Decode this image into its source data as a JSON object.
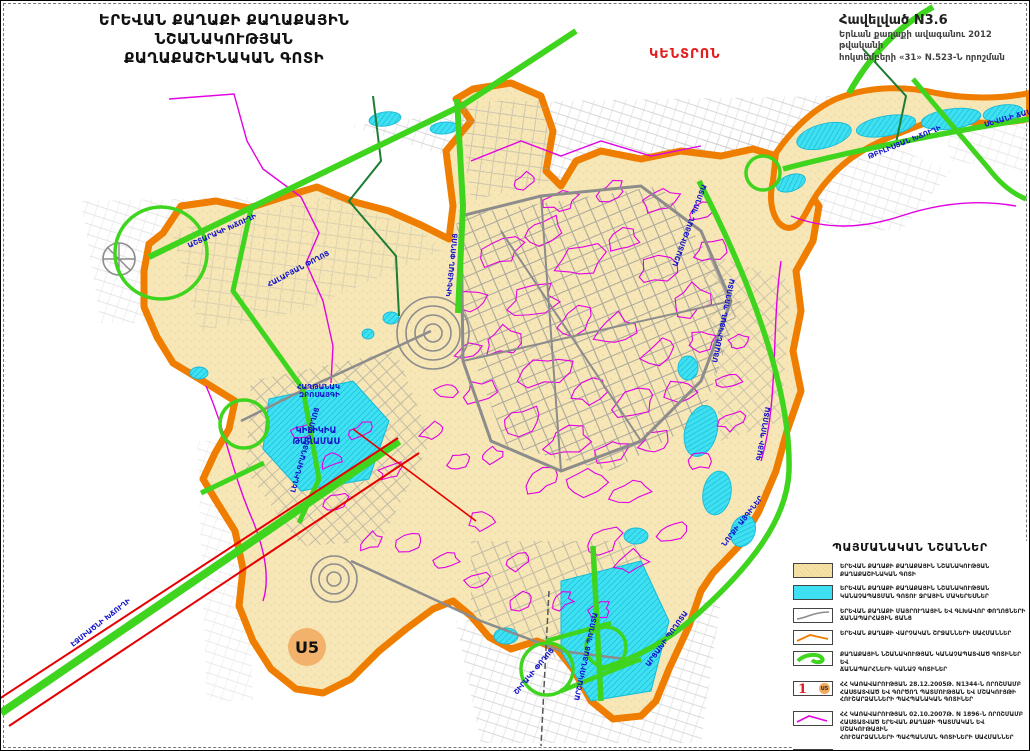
{
  "title": {
    "line1": "ԵՐԵՎԱՆ ՔԱՂԱՔԻ ՔԱՂԱՔԱՅԻՆ ՆՇԱՆԱԿՈՒԹՅԱՆ",
    "line2": "ՔԱՂԱՔԱՇԻՆԱԿԱՆ ԳՈՏԻ"
  },
  "annotation": {
    "line1": "Հավելված N3.6",
    "line2": "Երևան քաղաքի ավագանու 2012 թվականի",
    "line3": "հոկտեմբերի «31» N.523-Ն   որոշման"
  },
  "district_label": "ԿԵՆՏՐՈՆ",
  "map": {
    "marker_u5": "U5",
    "area_label": {
      "line1": "ԿԻԼԻԿԻԱ",
      "line2": "ԹԱՂԱՄԱՍ"
    },
    "street_labels": [
      {
        "text": "ԱՇՏԱՐԱԿԻ ԽՃՈՒՂԻ",
        "x": 188,
        "y": 247,
        "rot": -24
      },
      {
        "text": "ՀԱԼԱԲՅԱՆ ՓՈՂՈՑ",
        "x": 268,
        "y": 286,
        "rot": -28
      },
      {
        "text": "ԷՋՄԻԱԾՆԻ ԽՃՈՒՂԻ",
        "x": 72,
        "y": 646,
        "rot": -38
      },
      {
        "text": "ԼԵՆԻՆԳՐԱԴՅԱՆ ՓՈՂՈՑ",
        "x": 294,
        "y": 492,
        "rot": -74
      },
      {
        "text": "ԿԻԵՎՅԱՆ ՓՈՂՈՑ",
        "x": 450,
        "y": 296,
        "rot": -84
      },
      {
        "text": "ԱԶԱՏՈՒԹՅԱՆ ՊՈՂՈՏԱ",
        "x": 676,
        "y": 266,
        "rot": -70
      },
      {
        "text": "ՄՅԱՍՆԻԿՅԱՆ ՊՈՂՈՏԱ",
        "x": 716,
        "y": 362,
        "rot": -78
      },
      {
        "text": "ԳԱՅԻ ՊՈՂՈՏԱ",
        "x": 760,
        "y": 460,
        "rot": -80
      },
      {
        "text": "ՆՈՐՔԻ ԱՅԳԻՆԵՐ",
        "x": 724,
        "y": 546,
        "rot": -52
      },
      {
        "text": "ՇԻՐԱԿԻ ՓՈՂՈՑ",
        "x": 516,
        "y": 694,
        "rot": -50
      },
      {
        "text": "ԱՐՇԱԿՈՒՆՅԱՑ ՊՈՂՈՏԱ",
        "x": 578,
        "y": 700,
        "rot": -78
      },
      {
        "text": "ԱՐՑԱԽԻ ՊՈՂՈՏԱ",
        "x": 648,
        "y": 666,
        "rot": -54
      },
      {
        "text": "ԹԲԻԼԻՍՅԱՆ ԽՃՈՒՂԻ",
        "x": 868,
        "y": 158,
        "rot": -22
      },
      {
        "text": "ՍԵՎԱՆԻ ՃԱՆԱՊԱՐՀ",
        "x": 984,
        "y": 126,
        "rot": -16
      },
      {
        "text": "ՀԱՂԹԱՆԱԿ",
        "x": 296,
        "y": 388,
        "rot": 0
      },
      {
        "text": "ԶԲՈՍԱՅԳԻ",
        "x": 298,
        "y": 396,
        "rot": 0
      }
    ]
  },
  "legend": {
    "title": "ՊԱՅՄԱՆԱԿԱՆ ՆՇԱՆՆԵՐ",
    "items": [
      {
        "symbol": "beige-area",
        "lines": [
          "ԵՐԵՎԱՆ ՔԱՂԱՔԻ ՔԱՂԱՔԱՅԻՆ ՆՇԱՆԱԿՈՒԹՅԱՆ",
          "ՔԱՂԱՔԱՇԻՆԱԿԱՆ ԳՈՏԻ"
        ]
      },
      {
        "symbol": "cyan-area",
        "lines": [
          "ԵՐԵՎԱՆ ՔԱՂԱՔԻ ՔԱՂԱՔԱՅԻՆ ՆՇԱՆԱԿՈՒԹՅԱՆ",
          "ԿԱՆԱՉԱՊԱՏՄԱՆ ԳՈՏՈՒ ՋՐԱՅԻՆ ՄԱԿԵՐԵՍՆԵՐ"
        ]
      },
      {
        "symbol": "gray-road-line",
        "lines": [
          "ԵՐԵՎԱՆ ՔԱՂԱՔԻ ՄԱՅՐՈՒՂԱՅԻՆ ԵՎ ԳԼԽԱՎՈՐ ՓՈՂՈՑՆԵՐԻ",
          "ՃԱՆԱՊԱՐՀԱՅԻՆ ՑԱՆՑ"
        ]
      },
      {
        "symbol": "orange-line",
        "lines": [
          "ԵՐԵՎԱՆ ՔԱՂԱՔԻ ՎԱՐՉԱԿԱՆ ՇՐՋԱՆՆԵՐԻ ՍԱՀՄԱՆՆԵՐ"
        ]
      },
      {
        "symbol": "green-road-line",
        "lines": [
          "ՔԱՂԱՔԱՅԻՆ ՆՇԱՆԱԿՈՒԹՅԱՆ ԿԱՆԱՉԱՊԱՏՎԱԾ ԳՈՏԻՆԵՐ ԵՎ",
          "ՃԱՆԱՊԱՐՀՆԵՐԻ ԿԱՆԱՉ ԳՈՏԻՆԵՐ"
        ]
      },
      {
        "symbol": "monument-markers",
        "lines": [
          "ՀՀ ԿԱՌԱՎԱՐՈՒԹՅԱՆ 28.12.2005Թ. N1344-Ն ՈՐՈՇՄԱՄԲ",
          "ՀԱՍՏԱՏՎԱԾ ԵՎ ԳՈՐԾՈՂ ՊԱՏՄՈՒԹՅԱՆ ԵՎ ՄՇԱԿՈՒՅԹԻ",
          "ՀՈՒՇԱՐՁԱՆՆԵՐԻ ՊԱՀՊԱՆԱԿԱՆ ԳՈՏԻՆԵՐ"
        ]
      },
      {
        "symbol": "magenta-line",
        "lines": [
          "ՀՀ ԿԱՌԱՎԱՐՈՒԹՅԱՆ 02.10.2007Թ. N 1896-Ն ՈՐՈՇՄԱՄԲ",
          "ՀԱՍՏԱՏՎԱԾ ԵՐԵՎԱՆ ՔԱՂԱՔԻ ՊԱՏՄԱԿԱՆ ԵՎ ՄՇԱԿՈՒԹԱՅԻՆ",
          "ՀՈՒՇԱՐՁԱՆՆԵՐԻ ՊԱՀՊԱՆՄԱՆ ԳՈՏԻՆԵՐԻ ՍԱՀՄԱՆՆԵՐ"
        ]
      },
      {
        "symbol": "green-outline-area",
        "lines": [
          "ՔԱՂԱՔԱՅԻՆ ՆՇԱՆԱԿՈՒԹՅԱՆ ՀԱՏՈՒԿ ՊԱՀՊԱՆՎՈՂ",
          "ԲՆԱՊԱՀՊԱՆԱԿԱՆ ԳՈՏԻՆԵՐԻ ՍԱՀՄԱՆՆԵՐ"
        ]
      }
    ]
  },
  "colors": {
    "boundary_orange": "#ef7d00",
    "zone_beige": "#f7e7b6",
    "water_cyan": "#3fe0f2",
    "green_road": "#3fd41e",
    "dark_green": "#1c7d33",
    "magenta": "#e202e2",
    "red_line": "#e60000",
    "street_gray": "#8c8c8c",
    "label_blue": "#1414cc",
    "marker_orange": "#f2b26b",
    "district_red": "#e31e1e"
  }
}
